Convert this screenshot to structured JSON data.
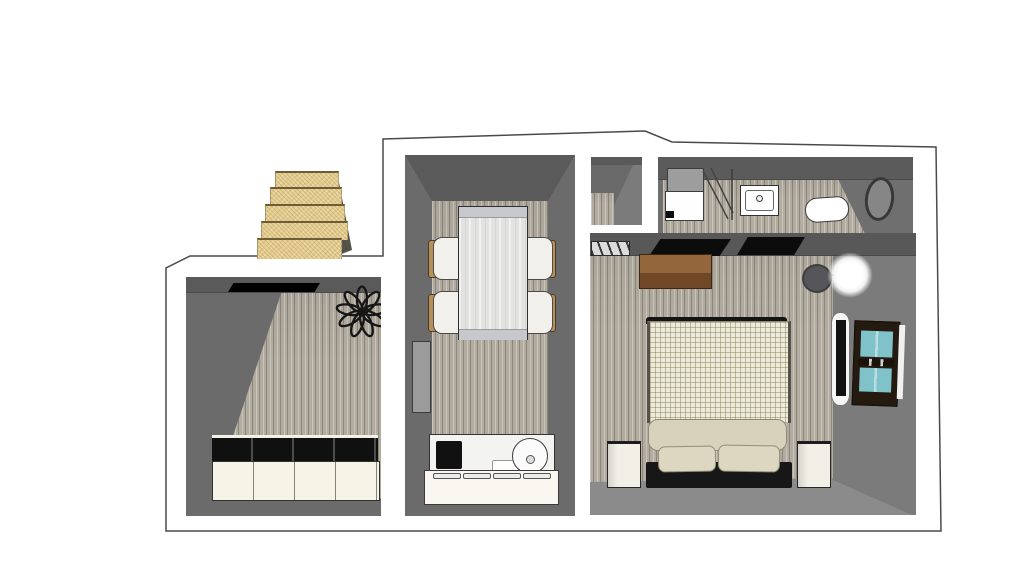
{
  "scene": {
    "type": "3d-floorplan-top-view",
    "description": "Top-down 3D rendered floor plan of a small apartment with staircase, closet room, kitchen-dining room, bathroom and bedroom",
    "rooms": [
      {
        "name": "staircase",
        "items": [
          {
            "name": "stair-steps",
            "count": 5
          }
        ]
      },
      {
        "name": "closet-room",
        "items": [
          {
            "name": "wardrobe-cabinet-row",
            "sections": 4
          },
          {
            "name": "plant"
          }
        ]
      },
      {
        "name": "kitchen-dining-room",
        "items": [
          {
            "name": "dining-table"
          },
          {
            "name": "chair",
            "count": 4
          },
          {
            "name": "door"
          },
          {
            "name": "kitchen-counter"
          },
          {
            "name": "cooktop"
          },
          {
            "name": "round-sink"
          },
          {
            "name": "cutting-board"
          },
          {
            "name": "drawer-handle",
            "count": 4
          }
        ]
      },
      {
        "name": "hallway-wall-stub",
        "items": []
      },
      {
        "name": "bathroom",
        "items": [
          {
            "name": "shower"
          },
          {
            "name": "washbasin"
          },
          {
            "name": "toilet"
          },
          {
            "name": "oval-mirror"
          }
        ]
      },
      {
        "name": "bedroom",
        "items": [
          {
            "name": "double-bed"
          },
          {
            "name": "pillow",
            "count": 2
          },
          {
            "name": "nightstand",
            "count": 2
          },
          {
            "name": "dresser"
          },
          {
            "name": "wall-lamp"
          },
          {
            "name": "glowing-light"
          },
          {
            "name": "window-teal"
          },
          {
            "name": "north-window",
            "count": 2
          },
          {
            "name": "louver-vent"
          }
        ]
      }
    ],
    "palette": {
      "wall": "#6b6b6b",
      "wallDark": "#5a5a5a",
      "wallFace": "#7b7b7b",
      "floorShadow": "#8b8b8b",
      "plank": "#b2aca0",
      "outline": "#4a4a4a",
      "stair": "#e5cd8e",
      "stairEdge": "#6d5c35",
      "stairShadow": "#55524a",
      "cream": "#f6f3e7",
      "counter": "#f3f4f2",
      "cooktop": "#111111",
      "table": "#e2e2e0",
      "tableCap": "#c6c8cb",
      "chairSeat": "#f1f0ea",
      "chairBack": "#b5905c",
      "door": "#9b9b9b",
      "duvet": "#eeeadb",
      "bolster": "#d8d2bc",
      "pillow": "#ddd7c2",
      "bedBase": "#171717",
      "nightstand": "#f1efe6",
      "dresserTop": "#94663c",
      "dresserFront": "#6f4827",
      "lampDisc": "#56565a",
      "teal": "#7fc2c9",
      "windowFrame": "#241a10",
      "mirrorRing": "#383838"
    }
  }
}
